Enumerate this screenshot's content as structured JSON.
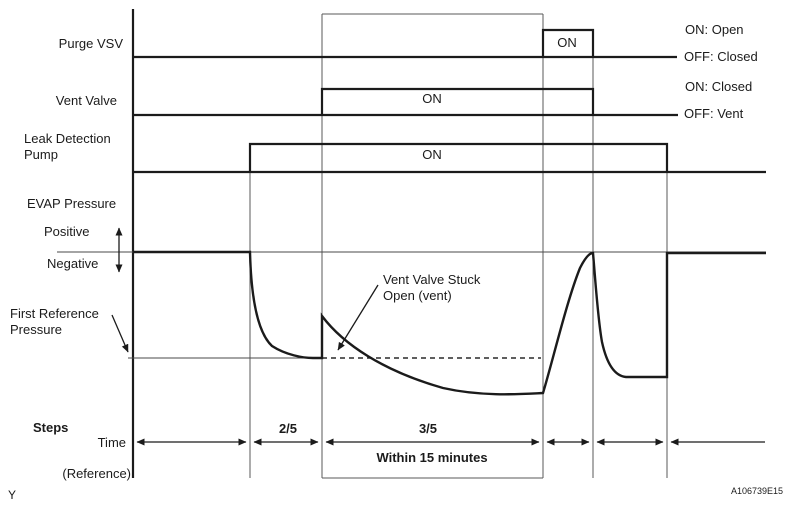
{
  "figure_code": "A106739E15",
  "corner_mark": "Y",
  "signals": {
    "purge_vsv": {
      "label": "Purge VSV",
      "on_label": "ON",
      "legend_on": "ON: Open",
      "legend_off": "OFF: Closed"
    },
    "vent_valve": {
      "label": "Vent Valve",
      "on_label": "ON",
      "legend_on": "ON: Closed",
      "legend_off": "OFF: Vent"
    },
    "leak_detection_pump": {
      "label_line1": "Leak Detection",
      "label_line2": "Pump",
      "on_label": "ON"
    }
  },
  "pressure": {
    "label": "EVAP Pressure",
    "positive_label": "Positive",
    "negative_label": "Negative",
    "reference_label_line1": "First Reference",
    "reference_label_line2": "Pressure",
    "annotation_line1": "Vent Valve Stuck",
    "annotation_line2": "Open (vent)"
  },
  "timeline": {
    "steps_label": "Steps",
    "time_label": "Time",
    "reference_label": "(Reference)",
    "step_2_5": "2/5",
    "step_3_5": "3/5",
    "duration_label": "Within 15 minutes"
  },
  "colors": {
    "ink": "#1b1b1b",
    "grid": "#5a5a5a",
    "background": "#ffffff"
  }
}
